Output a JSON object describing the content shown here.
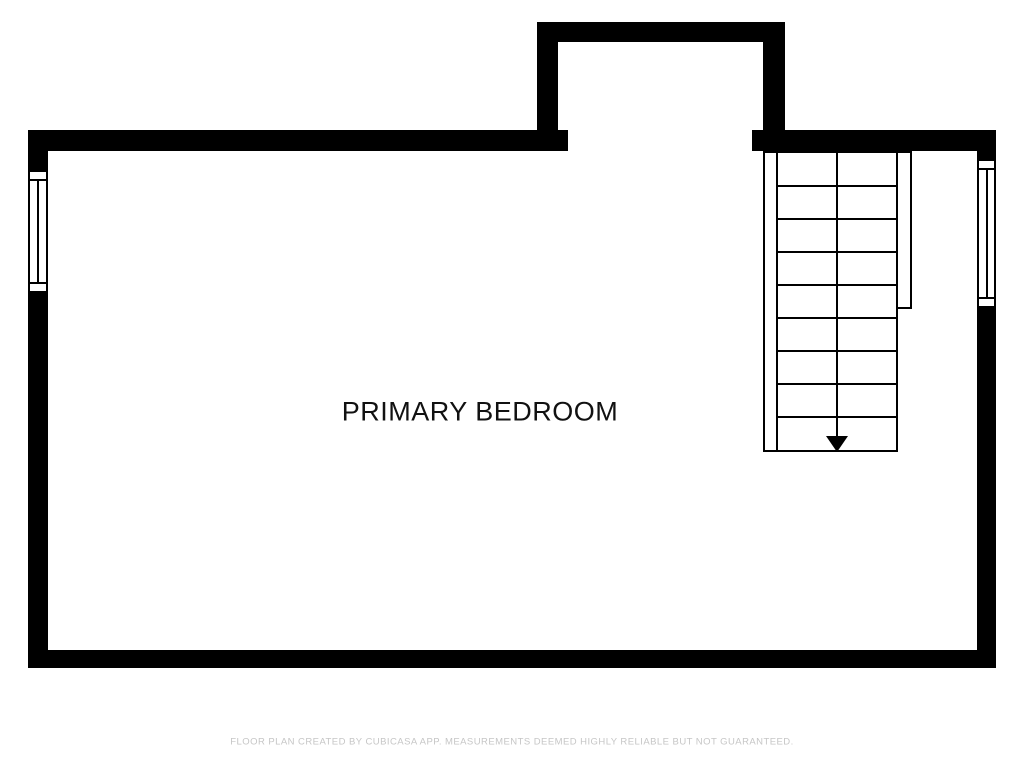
{
  "room": {
    "label": "PRIMARY BEDROOM"
  },
  "footer": {
    "disclaimer": "FLOOR PLAN CREATED BY CUBICASA APP. MEASUREMENTS DEEMED HIGHLY RELIABLE BUT NOT GUARANTEED."
  },
  "floor_plan": {
    "staircase": {
      "steps": 9,
      "direction_icon": "down-arrow"
    },
    "windows": [
      "left-wall-window",
      "right-wall-window"
    ],
    "colors": {
      "wall": "#000000",
      "line": "#000000",
      "label_text": "#111111",
      "disclaimer_text": "#c6c6c6",
      "background": "#ffffff"
    }
  }
}
